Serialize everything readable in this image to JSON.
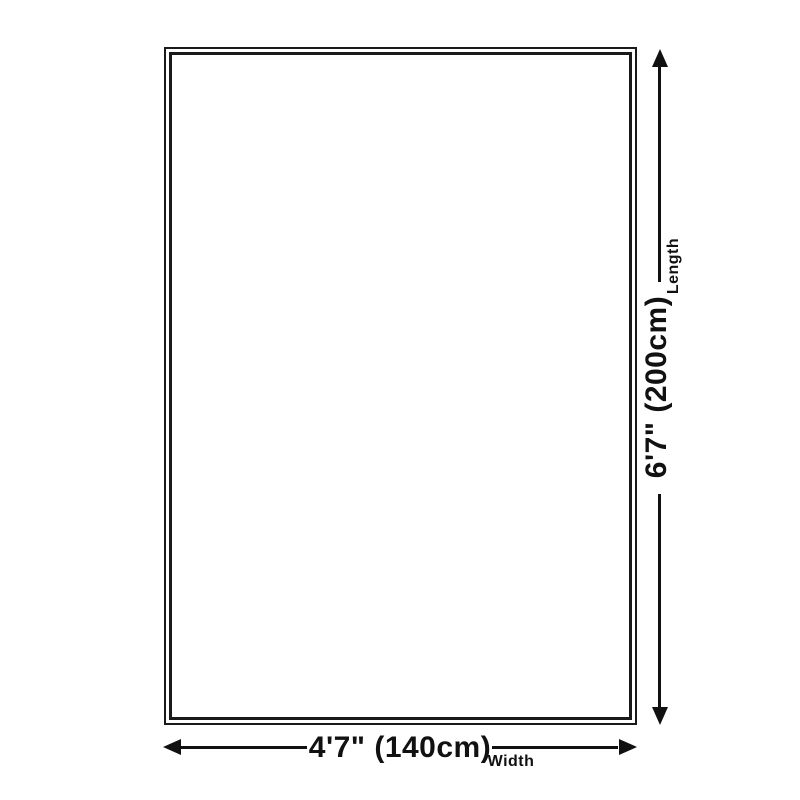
{
  "figure": {
    "background_color": "#ffffff",
    "line_color": "#111111",
    "length_dimension": {
      "value": "6'7\" (200cm)",
      "label": "Length",
      "orientation": "vertical"
    },
    "width_dimension": {
      "value": "4'7\" (140cm)",
      "label": "Width",
      "orientation": "horizontal"
    }
  }
}
